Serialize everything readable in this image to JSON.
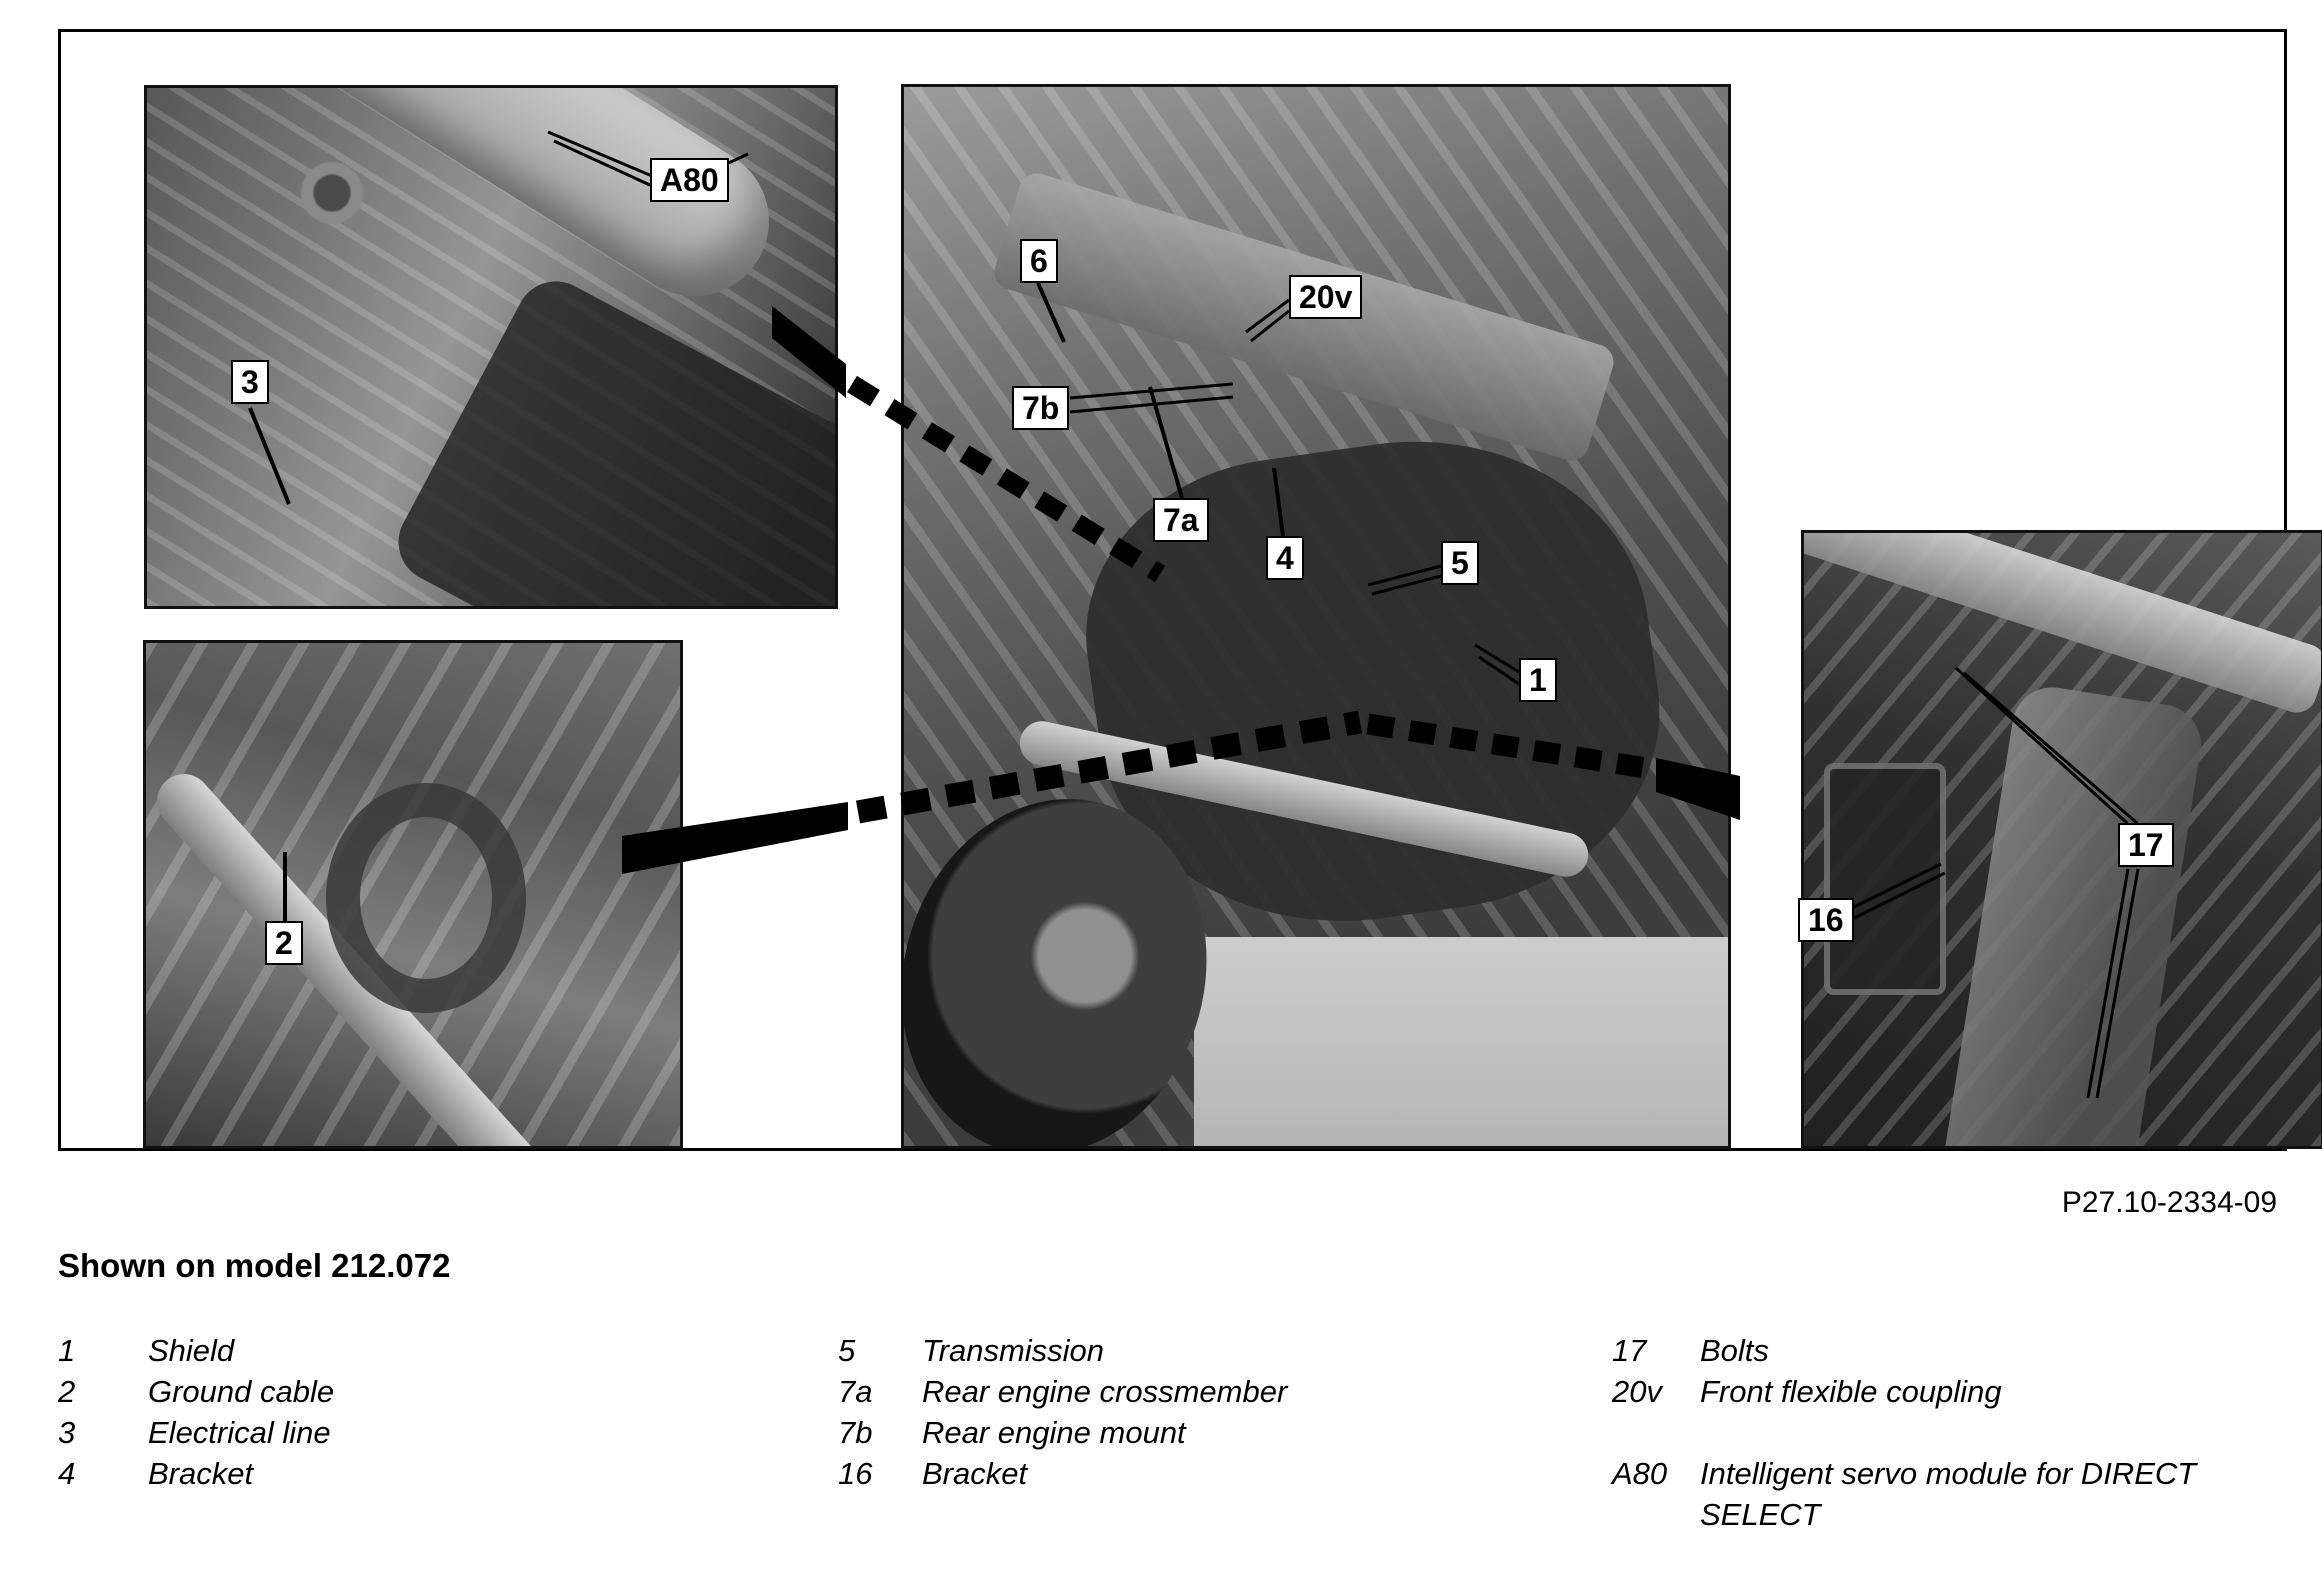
{
  "figure": {
    "code": "P27.10-2334-09",
    "caption": "Shown on model 212.072"
  },
  "callouts": {
    "a80": "A80",
    "n3": "3",
    "n2": "2",
    "n6": "6",
    "v20": "20v",
    "n7b": "7b",
    "n7a": "7a",
    "n4": "4",
    "n5": "5",
    "n1": "1",
    "n16": "16",
    "n17": "17"
  },
  "legend": {
    "col1": [
      {
        "key": "1",
        "label": "Shield"
      },
      {
        "key": "2",
        "label": "Ground cable"
      },
      {
        "key": "3",
        "label": "Electrical line"
      },
      {
        "key": "4",
        "label": "Bracket"
      }
    ],
    "col2": [
      {
        "key": "5",
        "label": "Transmission"
      },
      {
        "key": "7a",
        "label": "Rear engine crossmember"
      },
      {
        "key": "7b",
        "label": "Rear engine mount"
      },
      {
        "key": "16",
        "label": "Bracket"
      }
    ],
    "col3": [
      {
        "key": "17",
        "label": "Bolts"
      },
      {
        "key": "20v",
        "label": "Front flexible coupling"
      },
      {
        "key": "A80",
        "label": "Intelligent servo module for DIRECT SELECT"
      }
    ]
  }
}
